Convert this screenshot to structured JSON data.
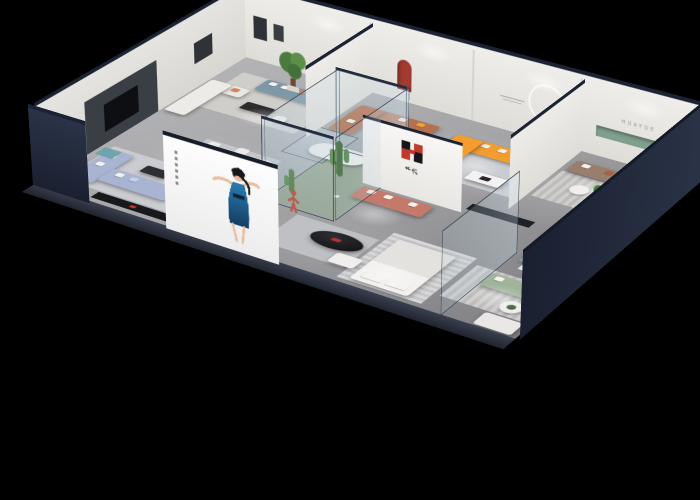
{
  "scene": {
    "type": "3d-isometric-cutaway-showroom-render",
    "background": "#000000",
    "description": "Bird's-eye isometric render of a furniture showroom apartment with cutaway navy walls on black"
  },
  "branding": {
    "logo_mark": "H",
    "logo_text": "华悦",
    "wall_lettering": "HUAYUE"
  },
  "palette": {
    "cut_wall_navy": "#1f2737",
    "wall_white": "#ebe9e5",
    "floor_gray": "#a6a6a8",
    "orange_sofa": "#f49d2f",
    "tan_sofa": "#b5714f",
    "coral_sofa": "#c4796a",
    "teal_sofa": "#7d98a6",
    "periwinkle_sofa": "#a9b4d2",
    "taupe_sofa": "#9a7e6d",
    "sage_sofa": "#9fb49b",
    "accent_red": "#a33b30",
    "niche_green": "#7fa08d",
    "billboard_dress_blue": "#1d5f8a",
    "statue_bronze": "#4a443e",
    "mannequin_terracotta": "#b65f4e"
  },
  "billboard": {
    "subject": "woman-in-blue-dress"
  },
  "rooms": [
    {
      "name": "lounge-teal",
      "items": [
        "potted-tree",
        "teal-sofa",
        "white-armchair",
        "white-sofa",
        "black-coffee-table",
        "area-rug",
        "red-floor-lamp"
      ]
    },
    {
      "name": "lounge-tan-leather",
      "items": [
        "tan-sectional-sofa",
        "red-arch-niche",
        "glass-display-case",
        "round-side-table"
      ]
    },
    {
      "name": "lounge-orange",
      "items": [
        "orange-sectional-sofa",
        "white-coffee-table",
        "bronze-statue",
        "ring-light",
        "area-rug"
      ]
    },
    {
      "name": "lounge-taupe",
      "items": [
        "taupe-sofa",
        "huayue-lettering",
        "green-wall-niche",
        "round-side-tables",
        "striped-rug"
      ]
    },
    {
      "name": "dining-area",
      "items": [
        "black-oval-dining-table",
        "white-dining-chairs"
      ]
    },
    {
      "name": "living-periwinkle",
      "items": [
        "periwinkle-sofa-set",
        "black-media-console",
        "coffee-table",
        "area-rug"
      ]
    },
    {
      "name": "central-atrium",
      "items": [
        "glass-enclosure",
        "cactus-plants",
        "terracotta-mannequin",
        "reception-desk",
        "coral-sofa",
        "logo-wall",
        "black-console"
      ]
    },
    {
      "name": "bedroom-display",
      "items": [
        "white-bed",
        "black-oval-coffee-table",
        "white-ottoman",
        "striped-rug"
      ]
    },
    {
      "name": "lounge-sage",
      "items": [
        "sage-sofa",
        "glass-partition",
        "blue-desk-set",
        "round-side-table",
        "white-loveseat"
      ]
    },
    {
      "name": "utility-strip",
      "items": [
        "washer",
        "teal-storage-cube"
      ]
    }
  ]
}
